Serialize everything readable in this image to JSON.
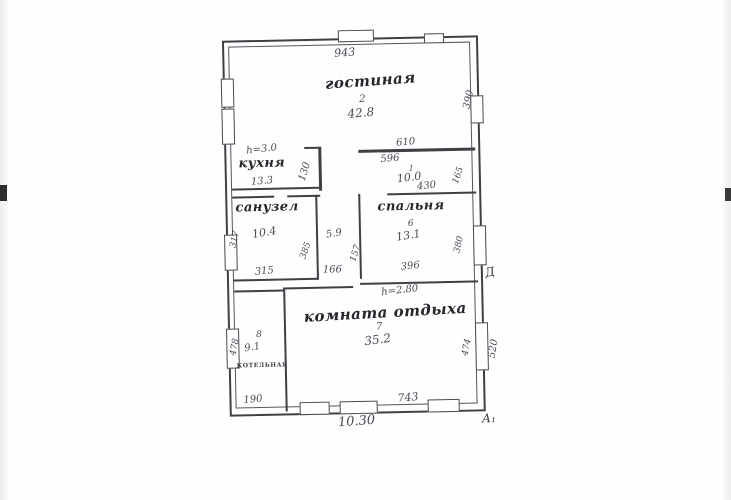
{
  "colors": {
    "ink": "#3c3c46",
    "paper": "#fefefe",
    "wall": "#3f3f46"
  },
  "plan": {
    "rooms": {
      "living": {
        "label": "гостиная",
        "number": "2",
        "area": "42.8"
      },
      "kitchen": {
        "label": "кухня",
        "area": "13.3"
      },
      "hall": {
        "number": "1",
        "area": "10.0"
      },
      "bath": {
        "label": "санузел",
        "area": "10.4"
      },
      "corridor": {
        "area": "5.9"
      },
      "bedroom": {
        "label": "спальня",
        "number": "6",
        "area": "13.1"
      },
      "lounge": {
        "label": "комната отдыха",
        "number": "7",
        "area": "35.2"
      },
      "boiler": {
        "label": "котельная",
        "number": "8",
        "area": "9.1"
      }
    },
    "notes": {
      "ceiling_top": "h=3.0",
      "ceiling_lounge": "h=2.80"
    },
    "dims": {
      "top_wall": "943",
      "hall_top": "610",
      "hall_inner": "596",
      "hall_bottom": "430",
      "right_top": "390",
      "right_gap": "165",
      "kitchen_wall": "130",
      "bath_left": "317",
      "bath_right": "385",
      "bath_bottom": "315",
      "corridor_bottom": "166",
      "corridor_right": "157",
      "bedroom_bottom": "396",
      "bedroom_right": "380",
      "lounge_right": "474",
      "right_outer": "520",
      "boiler_left": "478",
      "boiler_bottom": "190",
      "lounge_bottom": "743",
      "total_bottom": "10.30"
    },
    "axis_marks": {
      "right": "Д",
      "bottom_right": "А₁"
    }
  }
}
